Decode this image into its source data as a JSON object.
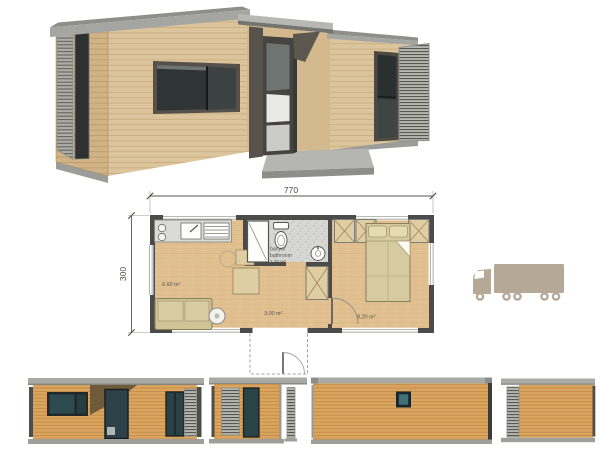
{
  "colors": {
    "background": "#ffffff",
    "wood_3d": "#dcc59d",
    "wood_elevation": "#daa55f",
    "roof_gray": "#a5a5a1",
    "glass_dark_3d": "#2f3534",
    "glass_teal_elevation": "#2c4b50",
    "louver_gray": "#b6b6b0",
    "plan_wall": "#4b4b4b",
    "plan_floor": "#e2c193",
    "bathroom_floor": "#d7d7d3",
    "furniture_beige": "#d5caa0",
    "truck_body": "#b5a896",
    "dimension_text": "#4a4a44",
    "label_text": "#57574f"
  },
  "dimensions": {
    "width": "770",
    "depth": "300"
  },
  "rooms": {
    "living_kitchen_area": "6.60 m²",
    "bathroom_label_line1": "banyo/",
    "bathroom_label_line2": "bathroom",
    "bathroom_area": "2.40 m²",
    "hall_area": "3.00 m²",
    "bedroom_area": "8.20 m²"
  },
  "icons": {
    "truck": "cargo-truck-icon"
  }
}
